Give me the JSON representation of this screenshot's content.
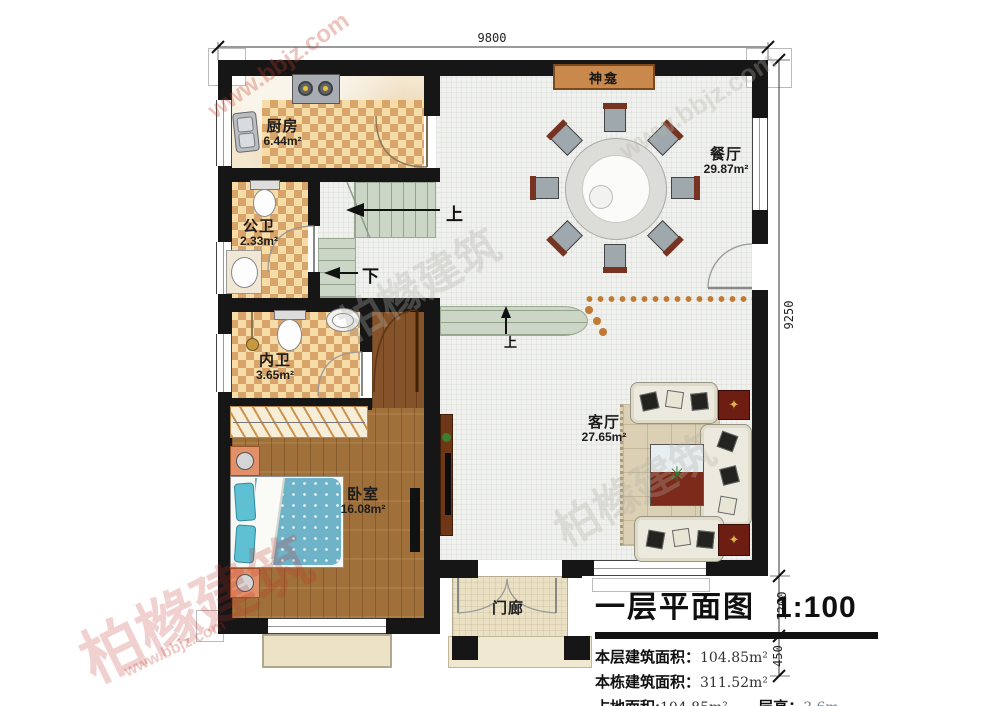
{
  "dimensions": {
    "top_width": "9800",
    "right_height": "9250",
    "right_porch": "1200",
    "right_step": "450"
  },
  "rooms": {
    "kitchen": {
      "name": "厨房",
      "area": "6.44m²"
    },
    "public_bath": {
      "name": "公卫",
      "area": "2.33m²"
    },
    "inner_bath": {
      "name": "内卫",
      "area": "3.65m²"
    },
    "bedroom": {
      "name": "卧室",
      "area": "16.08m²"
    },
    "living_room": {
      "name": "客厅",
      "area": "27.65m²"
    },
    "dining_room": {
      "name": "餐厅",
      "area": "29.87m²"
    },
    "porch": {
      "name": "门廊"
    },
    "shrine": {
      "name": "神龛"
    }
  },
  "stairs": {
    "up_label": "上",
    "down_label": "下",
    "step_up_label": "上"
  },
  "title_block": {
    "title": "一层平面图",
    "scale": "1:100",
    "rows": [
      {
        "label": "本层建筑面积：",
        "value": "104.85m²"
      },
      {
        "label": "本栋建筑面积：",
        "value": "311.52m²"
      },
      {
        "label": "占地面积:",
        "value": "104.85m²",
        "label2": "层高：",
        "value2": "3.6m"
      }
    ]
  },
  "watermark": {
    "brand": "柏橼建筑",
    "site": "www.bbjz.com"
  },
  "colors": {
    "wall": "#161616",
    "accent_shrine": "#c9894d",
    "dots": "#c07a33",
    "stair": "#ccd6c6"
  }
}
